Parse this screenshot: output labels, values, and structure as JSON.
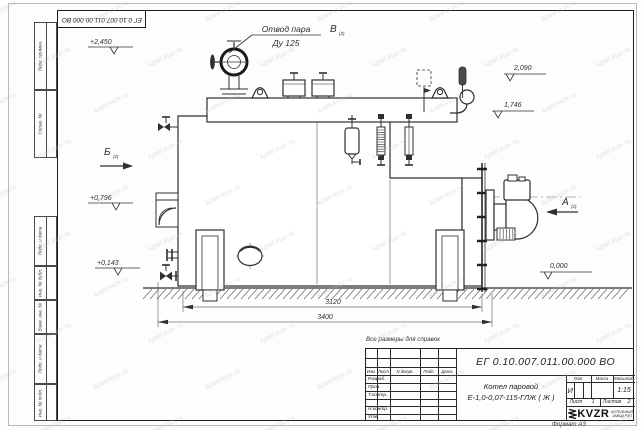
{
  "colors": {
    "line": "#2f2f2f",
    "frame": "#1c1c1c",
    "paper": "#fdfdfc",
    "watermark": "#b8c1ca"
  },
  "watermark_text": "kotel-kvzr.ru",
  "margin_labels": [
    "Перв. примен.",
    "Справ. №",
    "Подп. и дата",
    "Инв. № дубл.",
    "Взам. инв. №",
    "Подп. и дата",
    "Инв. № подл."
  ],
  "views": {
    "a": "А",
    "b": "Б",
    "v": "В",
    "sheet_ref": "(2)"
  },
  "callout_steam": {
    "line1": "Отвод пара",
    "line2": "Ду 125"
  },
  "elevations": {
    "e2450": "+2,450",
    "e2090": "2,090",
    "e1746": "1,746",
    "e0796": "+0,796",
    "e0143": "+0,143",
    "e0000": "0,000"
  },
  "dimensions": {
    "span_inner": "3120",
    "span_overall": "3400"
  },
  "note": "Все размеры для справок",
  "title_block": {
    "doc_number": "ЕГ 0.10.007.011.00.000  ВО",
    "name_line1": "Котел паровой",
    "name_line2": "Е-1,0-0,07-115-ГЛЖ ( Ж )",
    "col_izm": "Изм.",
    "col_list": "Лист",
    "col_ndoc": "N докум.",
    "col_podp": "Подп.",
    "col_data": "Дата",
    "row_razrab": "Разраб.",
    "row_prov": "Пров.",
    "row_tkontr": "Т.контр.",
    "row_nkontr": "Н.контр.",
    "row_utv": "Утв.",
    "lit_label": "Лит.",
    "lit_value": "И",
    "massa_label": "Масса",
    "masshtab_label": "Масштаб",
    "scale_value": "1:15",
    "sheet_label": "Лист",
    "sheet_value": "1",
    "sheets_label": "Листов",
    "sheets_value": "2",
    "logo_text": "KVZR",
    "logo_sub1": "КОТЕЛЬНЫЙ",
    "logo_sub2": "ЗАВОД РЭП",
    "format_label": "Формат А3"
  }
}
